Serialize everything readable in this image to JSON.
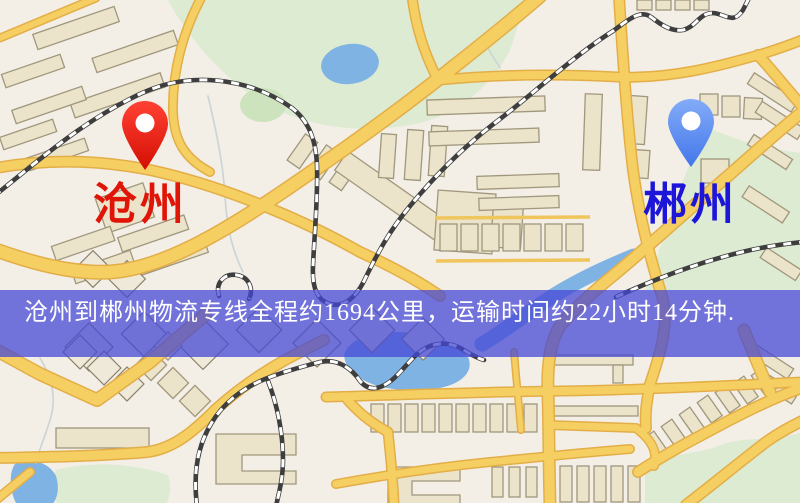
{
  "banner": {
    "text": "沧州到郴州物流专线全程约1694公里，运输时间约22小时14分钟.",
    "background_color": "#4648d5",
    "text_color": "#ffffff"
  },
  "markers": {
    "origin": {
      "label": "沧州",
      "label_color": "#e01507",
      "pin_color": "#e8130a",
      "icon": "red-location-pin"
    },
    "destination": {
      "label": "郴州",
      "label_color": "#1d16d9",
      "pin_color": "#5b8cf0",
      "icon": "blue-location-pin"
    }
  },
  "map_palette": {
    "background": "#f3efe7",
    "road": "#f6cf63",
    "road_casing": "#e3ae47",
    "railway": "#3e3e3e",
    "building": "#ebe3ca",
    "park": "#dcebd1",
    "water": "#7fb3e4"
  }
}
